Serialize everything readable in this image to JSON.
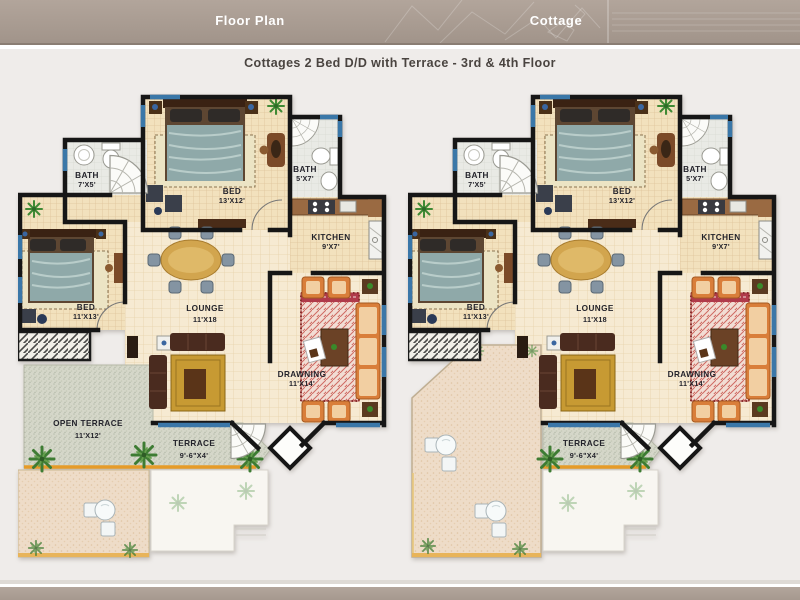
{
  "header": {
    "left_tab": "Floor Plan",
    "right_tab": "Cottage"
  },
  "page_title": "Cottages 2 Bed D/D with Terrace - 3rd & 4th Floor",
  "colors": {
    "header_bar": "#a89b91",
    "window_blue": "#3a77a8",
    "wall_black": "#161616",
    "floor_beige": "#f2e1bd",
    "bath_gray": "#e9e9e6",
    "terrace_green": "#d5d7c9",
    "terrace_sand": "#eedcc8",
    "railing_orange": "#e59b28",
    "palm_green": "#3f7d33",
    "sofa_maroon": "#4a2b1f",
    "drawing_orange": "#d97e3a",
    "bed_teal": "#8fa9a9"
  },
  "plans": [
    {
      "id": "floor-plan-left",
      "rooms": {
        "bed_top": {
          "name": "BED",
          "size": "13'X12'"
        },
        "bath_left": {
          "name": "BATH",
          "size": "7'X5'"
        },
        "bath_right": {
          "name": "BATH",
          "size": "5'X7'"
        },
        "kitchen": {
          "name": "KITCHEN",
          "size": "9'X7'"
        },
        "bed_left": {
          "name": "BED",
          "size": "11'X13'"
        },
        "lounge": {
          "name": "LOUNGE",
          "size": "11'X18"
        },
        "drawing": {
          "name": "DRAWNING",
          "size": "11'X14'"
        },
        "open_terrace": {
          "name": "OPEN TERRACE",
          "size": "11'X12'"
        },
        "terrace": {
          "name": "TERRACE",
          "size": "9'-6\"X4'"
        }
      }
    },
    {
      "id": "floor-plan-right",
      "rooms": {
        "bed_top": {
          "name": "BED",
          "size": "13'X12'"
        },
        "bath_left": {
          "name": "BATH",
          "size": "7'X5'"
        },
        "bath_right": {
          "name": "BATH",
          "size": "5'X7'"
        },
        "kitchen": {
          "name": "KITCHEN",
          "size": "9'X7'"
        },
        "bed_left": {
          "name": "BED",
          "size": "11'X13'"
        },
        "lounge": {
          "name": "LOUNGE",
          "size": "11'X18"
        },
        "drawing": {
          "name": "DRAWNING",
          "size": "11'X14'"
        },
        "terrace": {
          "name": "TERRACE",
          "size": "9'-6\"X4'"
        }
      }
    }
  ]
}
